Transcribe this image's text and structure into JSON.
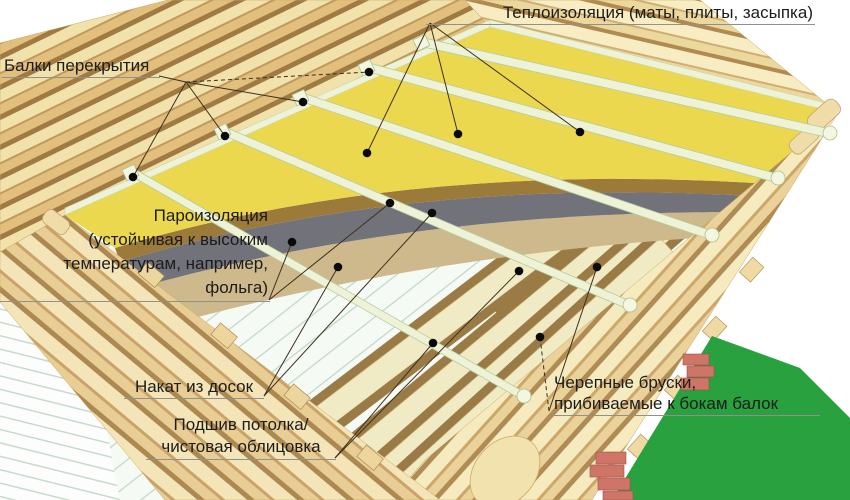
{
  "labels": {
    "beams": "Балки перекрытия",
    "insulation": "Теплоизоляция (маты, плиты, засыпка)",
    "vapor_1": "Пароизоляция",
    "vapor_2": "(устойчивая к высоким",
    "vapor_3": "температурам, например,",
    "vapor_4": "фольга)",
    "boards": "Накат из досок",
    "lining_1": "Подшив потолка/",
    "lining_2": "чистовая облицовка",
    "bars_1": "Черепные бруски,",
    "bars_2": "прибиваемые к бокам балок"
  },
  "colors": {
    "background": "#ffffff",
    "insulation_yellow": "#ecd84e",
    "insulation_cut_edge": "#9c7a3a",
    "vapor_barrier_gray": "#72727a",
    "boards_tan": "#cdb98b",
    "ceiling_lining_white": "#f6faf5",
    "joist_light": "#eef3d8",
    "timber_cream": "#f0ebc4",
    "skull_bar_brown": "#9b7b45",
    "log_light": "#f2e2ab",
    "log_mid": "#e3c07c",
    "grass_green": "#28a13e",
    "brick_red": "#cf7568",
    "leader_line": "#3d2f1f",
    "marker_dot": "#0a0a0a"
  }
}
